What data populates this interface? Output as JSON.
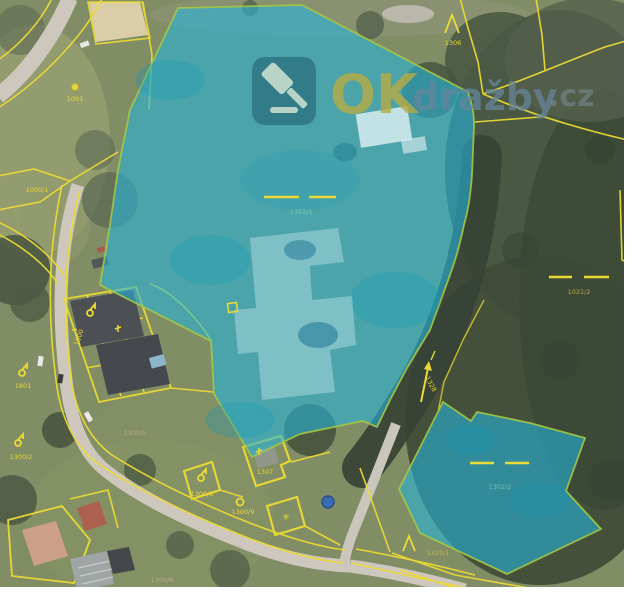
{
  "watermark": {
    "prefix": "OK",
    "middle": "dražby",
    "suffix": ".cz",
    "icon": "gavel-icon"
  },
  "colors": {
    "highlight_overlay": "#18b4dc",
    "highlight_border": "#9fc43c",
    "cadastral_line": "#ead92b",
    "watermark_prefix": "#b0a63c",
    "watermark_middle": "#5e7f96",
    "watermark_suffix": "#7d94a4",
    "watermark_badge": "#1f6276",
    "aerial_grass": "#7b875c",
    "aerial_forest": "#35432f",
    "road": "#cbc5bb",
    "point_marker_blue": "#2e66b0"
  },
  "parcel_labels": {
    "topleft_point": "1001",
    "left_field": "1000/1",
    "topright": "1306",
    "right": "1021/2",
    "main_highlight": "1302/1",
    "second_highlight": "1302/2",
    "road": "1328",
    "bottomright": "1329/1",
    "house": "1307",
    "yard": "1300/9",
    "left_point": "1801",
    "bottomleft_point": "1300/2",
    "buildings_row": "1500",
    "diamond": "1300/8",
    "bottom_faint_left": "1300/5",
    "bottom_faint": "1300/6"
  },
  "symbols": {
    "star_glyph": "✳"
  }
}
